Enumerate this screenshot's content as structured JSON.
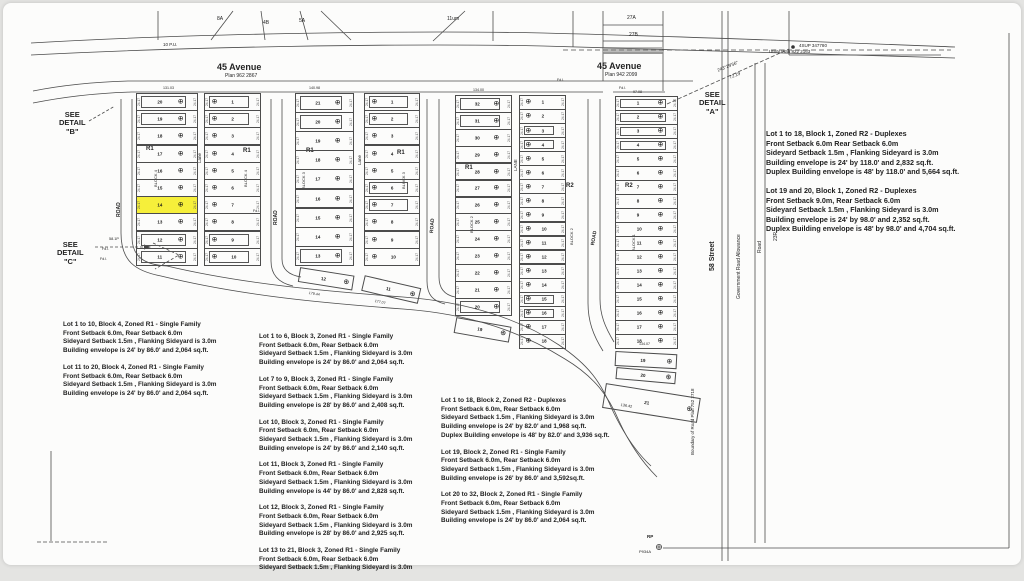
{
  "highlight_color": "#f6ef3a",
  "line_color": "#4c4c4c",
  "edge_dim": "24.17",
  "map_labels": [
    {
      "nm": "street-45-avenue-west",
      "t": "45 Avenue",
      "x": 214,
      "y": 60,
      "s": 9,
      "b": 1
    },
    {
      "nm": "plan-number-west",
      "t": "Plan 962 2867",
      "x": 222,
      "y": 71,
      "s": 5
    },
    {
      "nm": "street-45-avenue-east",
      "t": "45 Avenue",
      "x": 594,
      "y": 59,
      "s": 9,
      "b": 1
    },
    {
      "nm": "plan-number-east",
      "t": "Plan 942 2099",
      "x": 602,
      "y": 70,
      "s": 5
    },
    {
      "nm": "see-detail-b-label",
      "t": "SEE\nDETAIL\n\"B\"",
      "x": 56,
      "y": 108,
      "s": 7.5,
      "b": 1,
      "c": 1
    },
    {
      "nm": "see-detail-c-label",
      "t": "SEE\nDETAIL\n\"C\"",
      "x": 54,
      "y": 238,
      "s": 7.5,
      "b": 1,
      "c": 1
    },
    {
      "nm": "see-detail-a-label",
      "t": "SEE\nDETAIL\n\"A\"",
      "x": 696,
      "y": 88,
      "s": 7.5,
      "b": 1,
      "c": 1
    },
    {
      "t": "10 P.U.",
      "x": 160,
      "y": 40,
      "s": 4.5
    },
    {
      "t": "Utility Plan 822 2163",
      "x": 766,
      "y": 47,
      "s": 4.5
    },
    {
      "t": "8A",
      "x": 214,
      "y": 14,
      "s": 5
    },
    {
      "t": "4B",
      "x": 260,
      "y": 18,
      "s": 5
    },
    {
      "t": "5A",
      "x": 296,
      "y": 16,
      "s": 5
    },
    {
      "t": "11um",
      "x": 444,
      "y": 14,
      "s": 5
    },
    {
      "t": "27A",
      "x": 624,
      "y": 13,
      "s": 5
    },
    {
      "t": "27B",
      "x": 626,
      "y": 30,
      "s": 5
    },
    {
      "nm": "survey-marker-label",
      "t": "4SUP 347780",
      "x": 796,
      "y": 41,
      "s": 4.5
    },
    {
      "t": "243°29'56\"",
      "x": 714,
      "y": 66,
      "s": 4.5,
      "rot": -22
    },
    {
      "t": "72.19",
      "x": 726,
      "y": 73,
      "s": 4.5,
      "rot": -22
    },
    {
      "nm": "street-58-street",
      "t": "58 Street",
      "x": 706,
      "y": 268,
      "s": 7,
      "b": 1,
      "rot": -90
    },
    {
      "nm": "government-road-allowance-label",
      "t": "Government Road Allowance",
      "x": 734,
      "y": 296,
      "s": 5,
      "rot": -90
    },
    {
      "t": "Road",
      "x": 755,
      "y": 250,
      "s": 5,
      "rot": -90
    },
    {
      "t": "23R",
      "x": 771,
      "y": 238,
      "s": 5,
      "rot": -90
    },
    {
      "nm": "boundary-road-plan-label",
      "t": "Boundary of Road Plan 752 2718",
      "x": 688,
      "y": 452,
      "s": 4.5,
      "rot": -90
    },
    {
      "t": "ROAD",
      "x": 114,
      "y": 214,
      "s": 5,
      "b": 1,
      "rot": -90
    },
    {
      "t": "ROAD",
      "x": 271,
      "y": 222,
      "s": 5,
      "b": 1,
      "rot": -90
    },
    {
      "t": "ROAD",
      "x": 427,
      "y": 230,
      "s": 5,
      "b": 1,
      "rot": -86
    },
    {
      "t": "ROAD",
      "x": 588,
      "y": 242,
      "s": 5,
      "b": 1,
      "rot": -80
    },
    {
      "t": "Lane",
      "x": 195,
      "y": 160,
      "s": 4.5,
      "rot": -90
    },
    {
      "t": "Lane",
      "x": 355,
      "y": 162,
      "s": 4.5,
      "rot": -90
    },
    {
      "t": "LANE",
      "x": 511,
      "y": 168,
      "s": 4.5,
      "rot": -90
    },
    {
      "t": "BLOCK 4",
      "x": 151,
      "y": 184,
      "s": 4,
      "rot": -90
    },
    {
      "t": "BLOCK 4",
      "x": 241,
      "y": 184,
      "s": 4,
      "rot": -90
    },
    {
      "t": "BLOCK 3",
      "x": 299,
      "y": 186,
      "s": 4,
      "rot": -90
    },
    {
      "t": "BLOCK 3",
      "x": 399,
      "y": 186,
      "s": 4,
      "rot": -90
    },
    {
      "t": "BLOCK 2",
      "x": 467,
      "y": 230,
      "s": 4,
      "rot": -90
    },
    {
      "t": "BLOCK 2",
      "x": 567,
      "y": 242,
      "s": 4,
      "rot": -90
    },
    {
      "t": "BLOCK 1",
      "x": 629,
      "y": 248,
      "s": 4,
      "rot": -90
    },
    {
      "nm": "zone-r1-label",
      "t": "R1",
      "x": 143,
      "y": 143,
      "s": 6,
      "b": 1
    },
    {
      "nm": "zone-r1-label",
      "t": "R1",
      "x": 240,
      "y": 145,
      "s": 6,
      "b": 1
    },
    {
      "nm": "zone-r1-label",
      "t": "R1",
      "x": 303,
      "y": 145,
      "s": 6,
      "b": 1
    },
    {
      "nm": "zone-r1-label",
      "t": "R1",
      "x": 394,
      "y": 147,
      "s": 6,
      "b": 1
    },
    {
      "nm": "zone-r1-label",
      "t": "R1",
      "x": 462,
      "y": 162,
      "s": 6,
      "b": 1
    },
    {
      "nm": "zone-r2-label",
      "t": "R2",
      "x": 563,
      "y": 180,
      "s": 6,
      "b": 1
    },
    {
      "nm": "zone-r2-label",
      "t": "R2",
      "x": 622,
      "y": 180,
      "s": 6,
      "b": 1
    },
    {
      "t": "133.7P",
      "x": 158,
      "y": 206,
      "s": 3.6
    },
    {
      "t": "58.1P",
      "x": 106,
      "y": 234,
      "s": 3.8
    },
    {
      "t": "Fd.I.",
      "x": 99,
      "y": 245,
      "s": 3.6
    },
    {
      "t": "Fd.I.",
      "x": 97,
      "y": 255,
      "s": 3.6
    },
    {
      "t": "Fd.I.",
      "x": 250,
      "y": 207,
      "s": 3.6
    },
    {
      "t": "Fd.I.",
      "x": 554,
      "y": 76,
      "s": 3.6
    },
    {
      "t": "Fd.I.",
      "x": 616,
      "y": 84,
      "s": 3.6
    },
    {
      "t": "131.03",
      "x": 160,
      "y": 84,
      "s": 3.6
    },
    {
      "t": "140.98",
      "x": 306,
      "y": 84,
      "s": 3.6
    },
    {
      "t": "134.00",
      "x": 470,
      "y": 86,
      "s": 3.6
    },
    {
      "t": "97.08",
      "x": 630,
      "y": 88,
      "s": 3.6
    },
    {
      "t": "134.07",
      "x": 636,
      "y": 340,
      "s": 3.6
    },
    {
      "t": "136.42",
      "x": 618,
      "y": 400,
      "s": 3.8,
      "rot": 9
    },
    {
      "t": "179.44",
      "x": 306,
      "y": 289,
      "s": 3.6,
      "rot": 9
    },
    {
      "t": "177.07",
      "x": 372,
      "y": 297,
      "s": 3.6,
      "rot": 12
    },
    {
      "nm": "rp-marker-label",
      "t": "RP",
      "x": 644,
      "y": 532,
      "s": 4.5,
      "b": 1
    },
    {
      "t": "P934A",
      "x": 636,
      "y": 547,
      "s": 4
    }
  ],
  "blocks": [
    {
      "id": "block4-west",
      "x": 133,
      "y": 90,
      "w": 62,
      "h": 172,
      "rows": 10,
      "lots": [
        "20",
        "19",
        "18",
        "17",
        "16",
        "15",
        "14",
        "13",
        "12",
        "11"
      ],
      "env": [
        0,
        1,
        8,
        9
      ],
      "hl": [
        6
      ],
      "sym": "r"
    },
    {
      "id": "block4-east",
      "x": 201,
      "y": 90,
      "w": 57,
      "h": 172,
      "rows": 10,
      "lots": [
        "1",
        "2",
        "3",
        "4",
        "5",
        "6",
        "7",
        "8",
        "9",
        "10"
      ],
      "env": [
        0,
        1,
        8,
        9
      ],
      "sym": "l"
    },
    {
      "id": "block3-west",
      "x": 292,
      "y": 90,
      "w": 59,
      "h": 172,
      "rows": 9,
      "lots": [
        "21",
        "20",
        "19",
        "18",
        "17",
        "16",
        "15",
        "14",
        "13"
      ],
      "env": [
        0,
        1,
        8
      ],
      "sym": "r"
    },
    {
      "id": "block3-east",
      "x": 361,
      "y": 90,
      "w": 56,
      "h": 172,
      "rows": 10,
      "lots": [
        "1",
        "2",
        "3",
        "4",
        "5",
        "6",
        "7",
        "8",
        "9",
        "10"
      ],
      "env": [
        0,
        1,
        5,
        6
      ],
      "sym": "l"
    },
    {
      "id": "block2-west",
      "x": 452,
      "y": 92,
      "w": 57,
      "h": 220,
      "rows": 13,
      "lots": [
        "32",
        "31",
        "30",
        "29",
        "28",
        "27",
        "26",
        "25",
        "24",
        "23",
        "22",
        "21",
        "20"
      ],
      "env": [
        0,
        1,
        12
      ],
      "sym": "r"
    },
    {
      "id": "block2-east",
      "x": 516,
      "y": 92,
      "w": 47,
      "h": 253,
      "rows": 18,
      "lots": [
        "1",
        "2",
        "3",
        "4",
        "5",
        "6",
        "7",
        "8",
        "9",
        "10",
        "11",
        "12",
        "13",
        "14",
        "15",
        "16",
        "17",
        "18"
      ],
      "env": [
        2,
        3,
        14,
        15
      ],
      "sym": "l"
    },
    {
      "id": "block1",
      "x": 612,
      "y": 93,
      "w": 63,
      "h": 252,
      "rows": 18,
      "lots": [
        "1",
        "2",
        "3",
        "4",
        "5",
        "6",
        "7",
        "8",
        "9",
        "10",
        "11",
        "12",
        "13",
        "14",
        "15",
        "16",
        "17",
        "18"
      ],
      "env": [
        0,
        1,
        2,
        3
      ],
      "sym": "r"
    }
  ],
  "extra_lots": [
    {
      "blk": "block3",
      "n": "12",
      "x": 296,
      "y": 264,
      "w": 55,
      "h": 15,
      "rot": 9
    },
    {
      "blk": "block3",
      "n": "11",
      "x": 360,
      "y": 272,
      "w": 58,
      "h": 16,
      "rot": 13
    },
    {
      "blk": "block2",
      "n": "19",
      "x": 452,
      "y": 314,
      "w": 56,
      "h": 16,
      "rot": 10
    },
    {
      "blk": "block1",
      "n": "19",
      "x": 612,
      "y": 348,
      "w": 62,
      "h": 15,
      "rot": 3
    },
    {
      "blk": "block1",
      "n": "20",
      "x": 613,
      "y": 364,
      "w": 60,
      "h": 12,
      "rot": 5
    },
    {
      "blk": "block1",
      "n": "21",
      "x": 601,
      "y": 380,
      "w": 96,
      "h": 25,
      "rot": 9
    }
  ],
  "notes": {
    "col1": {
      "x": 60,
      "y": 318,
      "size": "s",
      "paras": [
        [
          "Lot 1 to 10, Block 4, Zoned R1 - Single Family",
          "Front Setback 6.0m, Rear Setback 6.0m",
          "Sideyard Setback 1.5m , Flanking Sideyard is 3.0m",
          "Building envelope is 24' by 86.0'  and 2,064 sq.ft."
        ],
        [
          "Lot 11 to 20, Block 4, Zoned R1 - Single Family",
          "Front Setback 6.0m, Rear Setback 6.0m",
          "Sideyard Setback 1.5m , Flanking Sideyard is 3.0m",
          "Building envelope is 24' by 86.0'  and 2,064 sq.ft."
        ]
      ]
    },
    "col2": {
      "x": 256,
      "y": 330,
      "size": "s",
      "paras": [
        [
          "Lot 1 to 6, Block 3, Zoned R1 - Single Family",
          "Front Setback 6.0m, Rear Setback 6.0m",
          "Sideyard Setback 1.5m , Flanking Sideyard is 3.0m",
          "Building envelope is 24' by 86.0'  and 2,064 sq.ft."
        ],
        [
          "Lot 7 to 9, Block 3, Zoned R1 - Single Family",
          "Front Setback 6.0m, Rear Setback 6.0m",
          "Sideyard Setback 1.5m , Flanking Sideyard is 3.0m",
          "Building envelope is 28' by 86.0'  and 2,408 sq.ft."
        ],
        [
          "Lot 10, Block 3, Zoned R1 - Single Family",
          "Front Setback 6.0m, Rear Setback 6.0m",
          "Sideyard Setback 1.5m , Flanking Sideyard is 3.0m",
          "Building envelope is 24' by 86.0'  and 2,140 sq.ft."
        ],
        [
          "Lot 11, Block 3, Zoned R1 - Single Family",
          "Front Setback 6.0m, Rear Setback 6.0m",
          "Sideyard Setback 1.5m , Flanking Sideyard is 3.0m",
          "Building envelope is 44' by 86.0'  and 2,828 sq.ft."
        ],
        [
          "Lot 12, Block 3, Zoned R1 - Single Family",
          "Front Setback 6.0m, Rear Setback 6.0m",
          "Sideyard Setback 1.5m , Flanking Sideyard is 3.0m",
          "Building envelope is 28' by 86.0'  and 2,925 sq.ft."
        ],
        [
          "Lot 13 to 21, Block 3, Zoned R1 - Single Family",
          "Front Setback 6.0m, Rear Setback 6.0m",
          "Sideyard Setback 1.5m , Flanking Sideyard is 3.0m"
        ]
      ]
    },
    "col3": {
      "x": 438,
      "y": 394,
      "size": "s",
      "paras": [
        [
          "Lot 1 to 18, Block 2, Zoned R2 - Duplexes",
          "Front Setback 6.0m, Rear Setback 6.0m",
          "Sideyard Setback 1.5m , Flanking Sideyard is 3.0m",
          "Building envelope is 24' by 82.0'  and 1,968 sq.ft.",
          "Duplex Building envelope is 48' by 82.0'  and 3,936 sq.ft."
        ],
        [
          "Lot 19, Block 2, Zoned R1 - Single Family",
          "Front Setback 6.0m, Rear Setback 6.0m",
          "Sideyard Setback 1.5m , Flanking Sideyard is 3.0m",
          "Building envelope is 26' by 86.0'  and 3,592sq.ft."
        ],
        [
          "Lot 20 to 32, Block 2, Zoned R1 - Single Family",
          "Front Setback 6.0m, Rear Setback 6.0m",
          "Sideyard Setback 1.5m , Flanking Sideyard is 3.0m",
          "Building envelope is 24' by 86.0'  and 2,064 sq.ft."
        ]
      ]
    },
    "col4": {
      "x": 763,
      "y": 126,
      "size": "l",
      "paras": [
        [
          "Lot 1 to 18, Block 1, Zoned R2 - Duplexes",
          "Front Setback 6.0m Rear Setback 6.0m",
          "Sideyard Setback 1.5m , Flanking Sideyard is 3.0m",
          "Building envelope is 24' by 118.0'  and 2,832 sq.ft.",
          "Duplex Building envelope is 48' by 118.0'  and 5,664 sq.ft."
        ],
        [
          "Lot 19 and 20, Block 1, Zoned R2 - Duplexes",
          "Front Setback 9.0m, Rear Setback 6.0m",
          "Sideyard Setback 1.5m , Flanking Sideyard is 3.0m",
          "Building envelope is 24' by 98.0'  and 2,352 sq.ft.",
          "Duplex Building envelope is 48' by 98.0'  and 4,704 sq.ft."
        ]
      ]
    }
  },
  "symbols": {
    "lot_marker": "⊕"
  }
}
